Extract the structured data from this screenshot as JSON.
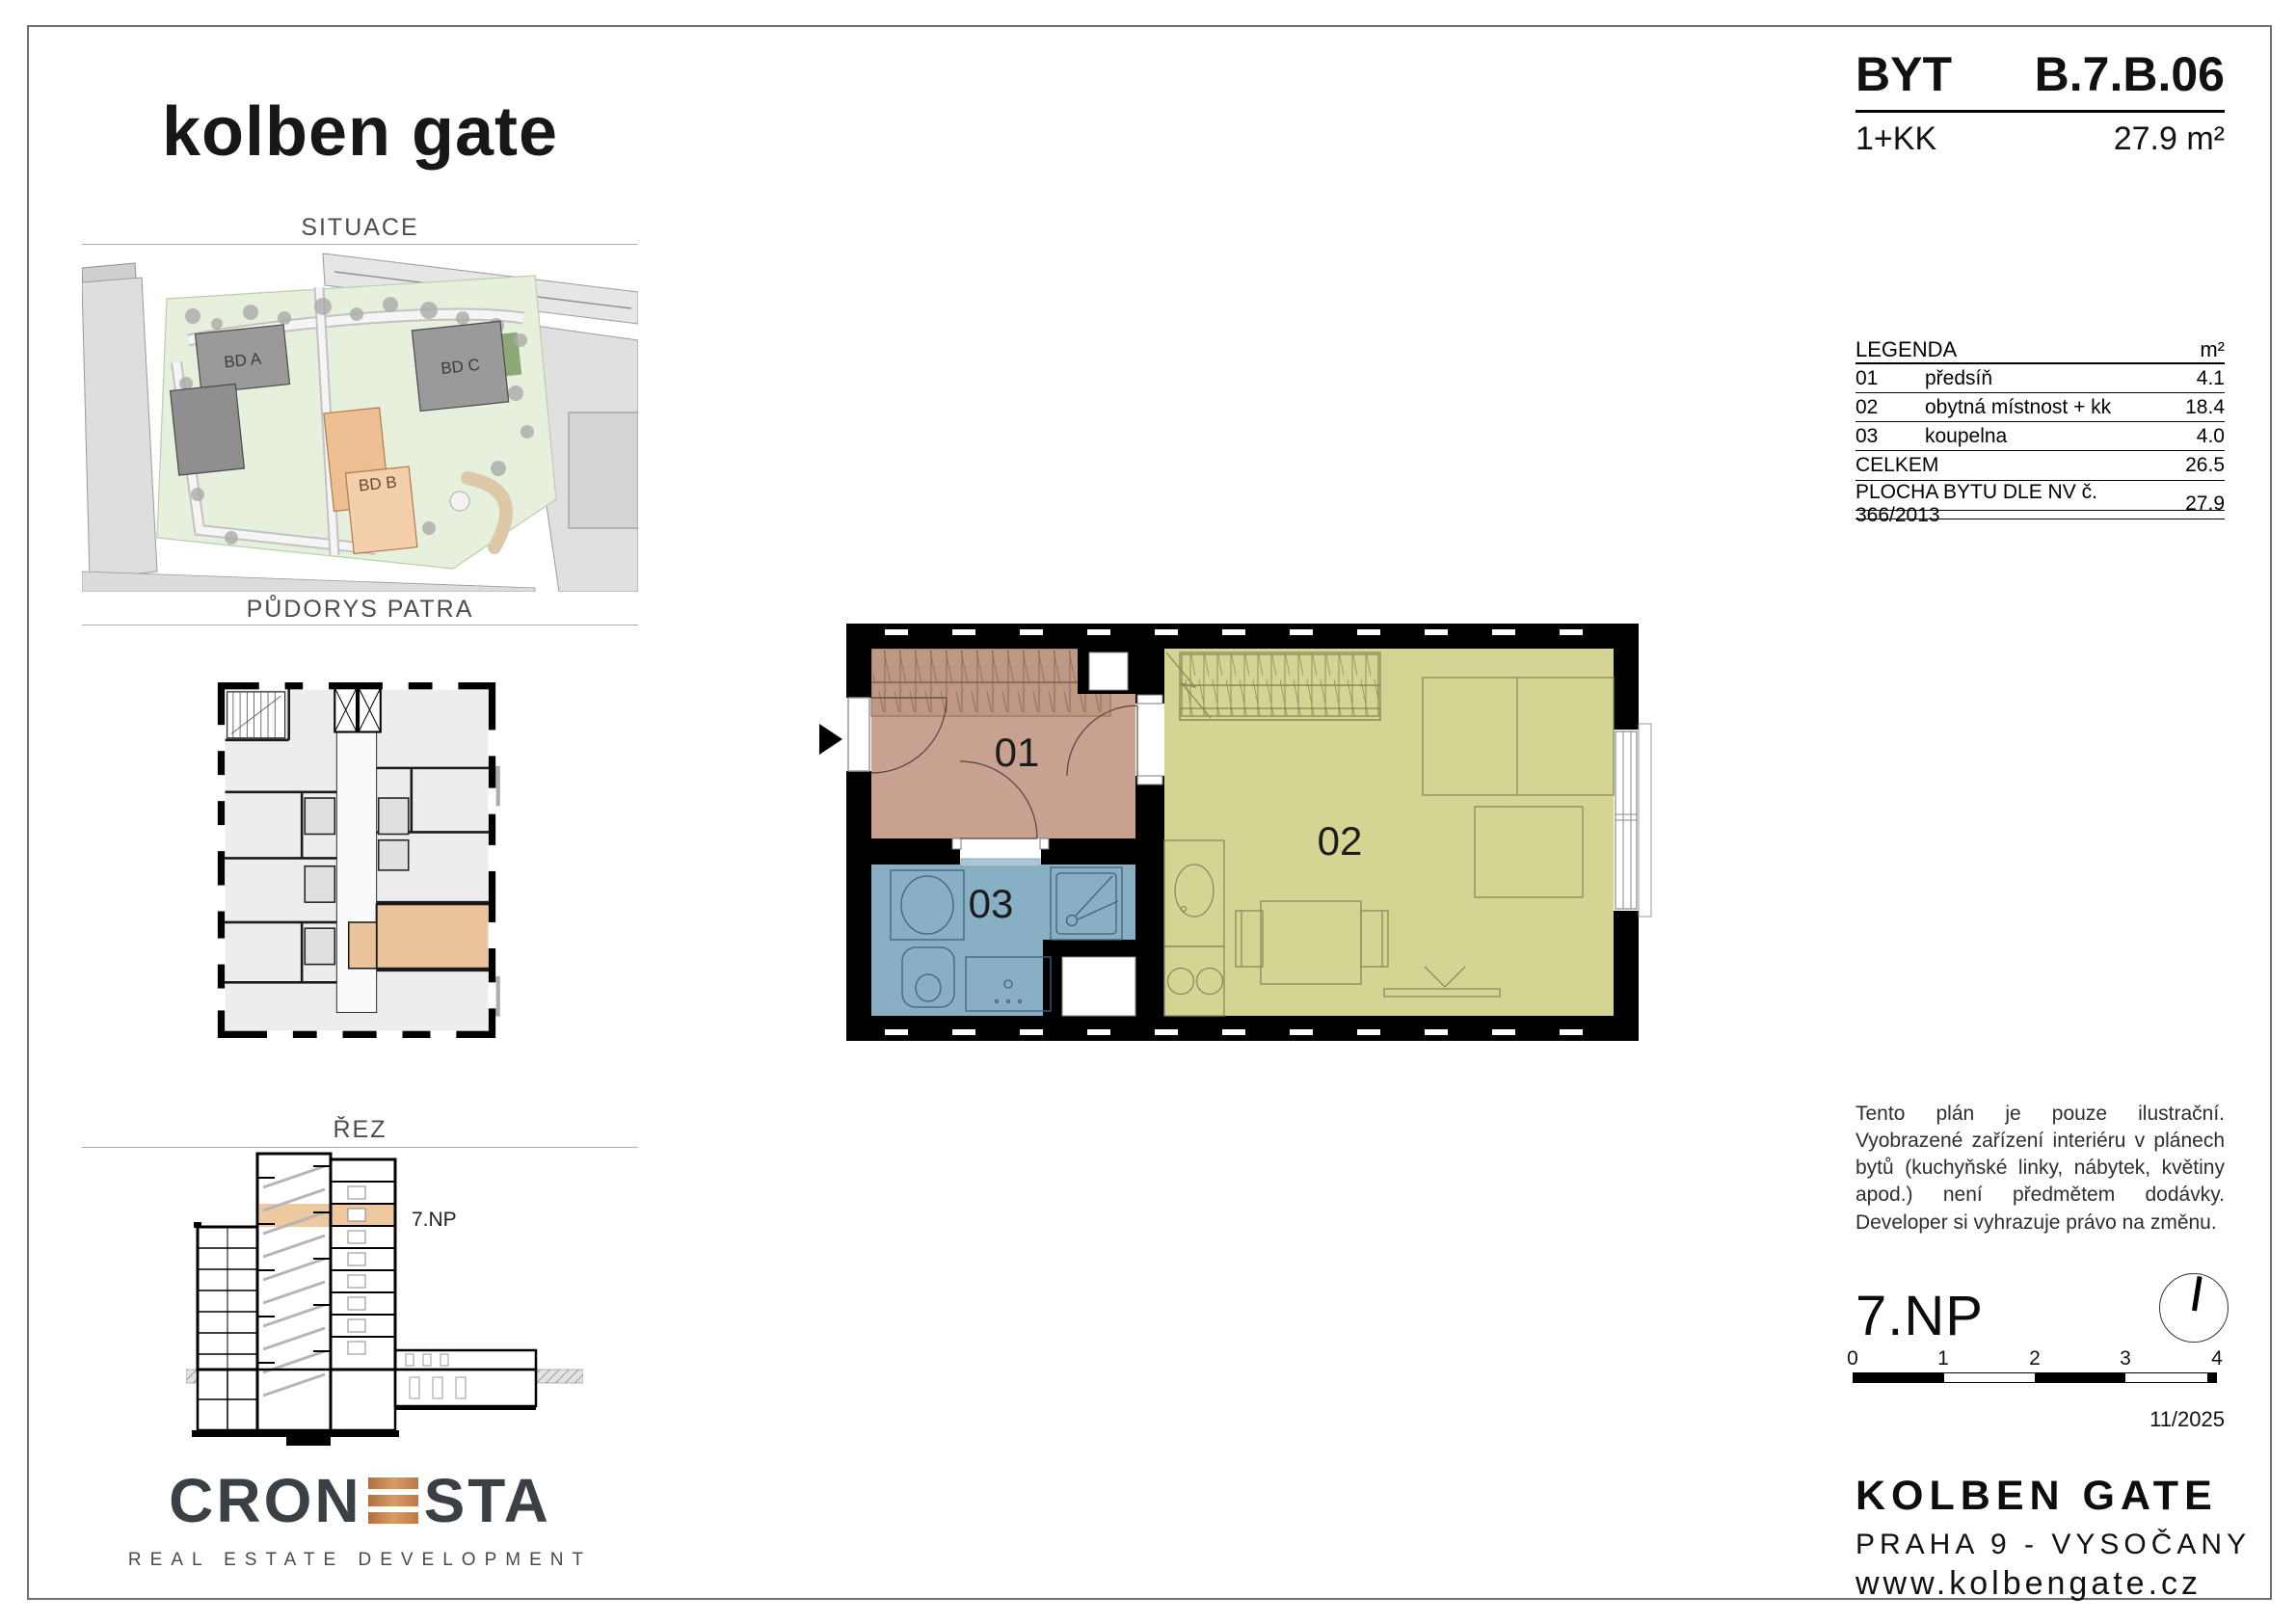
{
  "logo": {
    "text": "kolben gate"
  },
  "header": {
    "byt_label": "BYT",
    "unit_code": "B.7.B.06",
    "disposition": "1+KK",
    "area": "27.9 m²"
  },
  "sections": {
    "situace_title": "SITUACE",
    "pudorys_title": "PŮDORYS PATRA",
    "rez_title": "ŘEZ"
  },
  "site_plan": {
    "building_a": "BD A",
    "building_b": "BD B",
    "building_c": "BD C"
  },
  "section_drawing": {
    "floor_label": "7.NP"
  },
  "plan": {
    "room01_label": "01",
    "room02_label": "02",
    "room03_label": "03"
  },
  "legend": {
    "title": "LEGENDA",
    "area_unit": "m²",
    "rows": [
      {
        "num": "01",
        "name": "předsíň",
        "area": "4.1"
      },
      {
        "num": "02",
        "name": "obytná místnost + kk",
        "area": "18.4"
      },
      {
        "num": "03",
        "name": "koupelna",
        "area": "4.0"
      }
    ],
    "total_label": "CELKEM",
    "total_area": "26.5",
    "statutory_label": "PLOCHA BYTU DLE NV č. 366/2013",
    "statutory_area": "27.9"
  },
  "disclaimer": "Tento plán je pouze ilustrační. Vyobrazené zařízení interiéru v plánech bytů (kuchyňské linky, nábytek, květiny apod.) není předmětem dodávky. Developer si vyhrazuje právo na změnu.",
  "floor_info": {
    "floor_label": "7.NP",
    "date": "11/2025"
  },
  "scale_bar": {
    "ticks": [
      "0",
      "1",
      "2",
      "3",
      "4"
    ]
  },
  "footer": {
    "project": "KOLBEN GATE",
    "location": "PRAHA 9 - VYSOČANY",
    "website": "www.kolbengate.cz"
  },
  "developer": {
    "name_part1": "CRON",
    "name_part2": "STA",
    "tagline": "REAL ESTATE DEVELOPMENT"
  },
  "colors": {
    "room01_fill": "#c8a190",
    "room02_fill": "#d5d593",
    "room03_fill": "#88afc3",
    "highlight_orange": "#ecc49c",
    "cronesta_copper": "#c08552",
    "site_green": "#e7f0dd",
    "building_gray": "#9c9c9c"
  }
}
